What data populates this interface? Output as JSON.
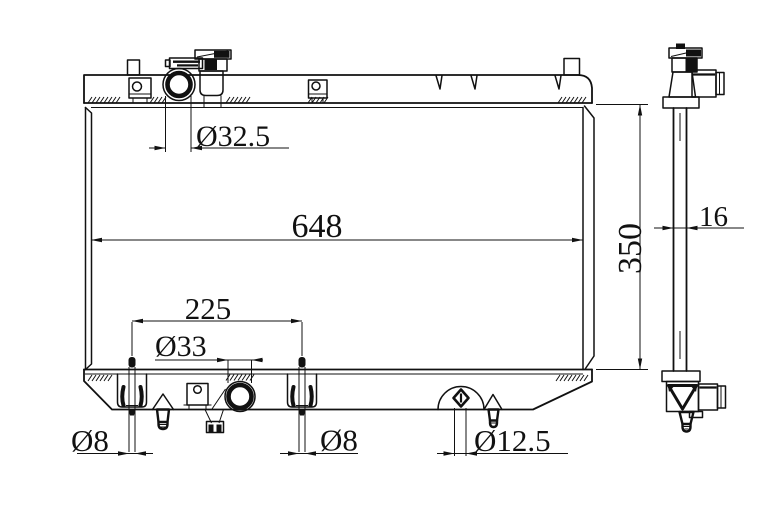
{
  "drawing": {
    "title": "Radiator engineering drawing, front and side views",
    "colors": {
      "ink": "#111111",
      "background": "#ffffff"
    },
    "dimensions": {
      "inlet_diameter": "Ø32.5",
      "core_width": "648",
      "core_height": "350",
      "pin_spacing": "225",
      "outlet_diameter": "Ø33",
      "pin_left_diameter": "Ø8",
      "pin_right_diameter": "Ø8",
      "drain_diameter": "Ø12.5",
      "core_thickness": "16"
    }
  }
}
